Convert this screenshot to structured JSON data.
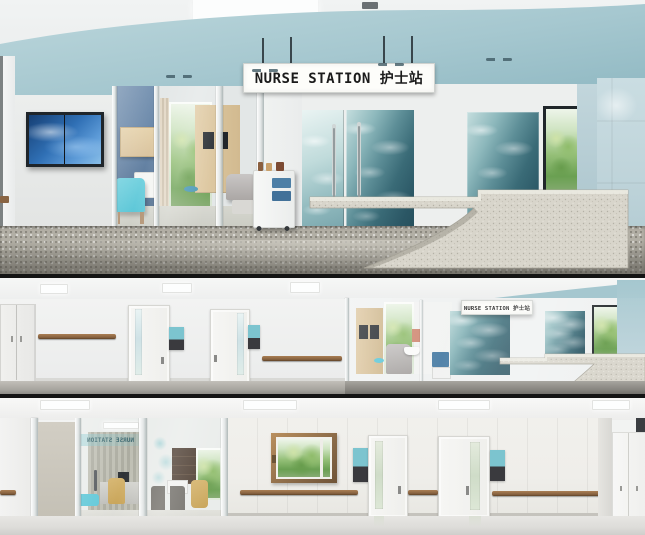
{
  "collage": {
    "panel_count": 3,
    "panels": [
      {
        "id": "top",
        "view": "nurse-station-lobby"
      },
      {
        "id": "middle",
        "view": "corridor-with-nurse-station"
      },
      {
        "id": "bottom",
        "view": "corridor-with-consultation-room"
      }
    ]
  },
  "signs": {
    "main_lightbox": "NURSE STATION 护士站",
    "corridor_lightbox": "NURSE STATION 护士站",
    "glass_mirrored": "NURSE STATION"
  },
  "colors": {
    "ceiling_teal": "#a5c7cf",
    "column_blue": "#bfd4da",
    "water_teal_dark": "#2e5d6b",
    "water_teal_light": "#cfe6e6",
    "terrazzo_desk": "#d8d5cb",
    "floor_terrazzo": "#b2afa5",
    "wall_white": "#eff0ef",
    "wall_cream": "#efeeea",
    "accent_wall_blue": "#5f7ea1",
    "chair_teal": "#57c5d6",
    "cart_drawer_blue": "#4d7fa6",
    "wood_light": "#d9c29c",
    "handrail_wood": "#85603f",
    "sign_plate_teal": "#7cc4cf",
    "sign_plate_dark": "#3a3a3e",
    "signboard_bg": "#fdfdfa",
    "signboard_text": "#1b1b1b",
    "greenery": "#7bb163",
    "tv_screen_blue": "#2f6fb4"
  }
}
